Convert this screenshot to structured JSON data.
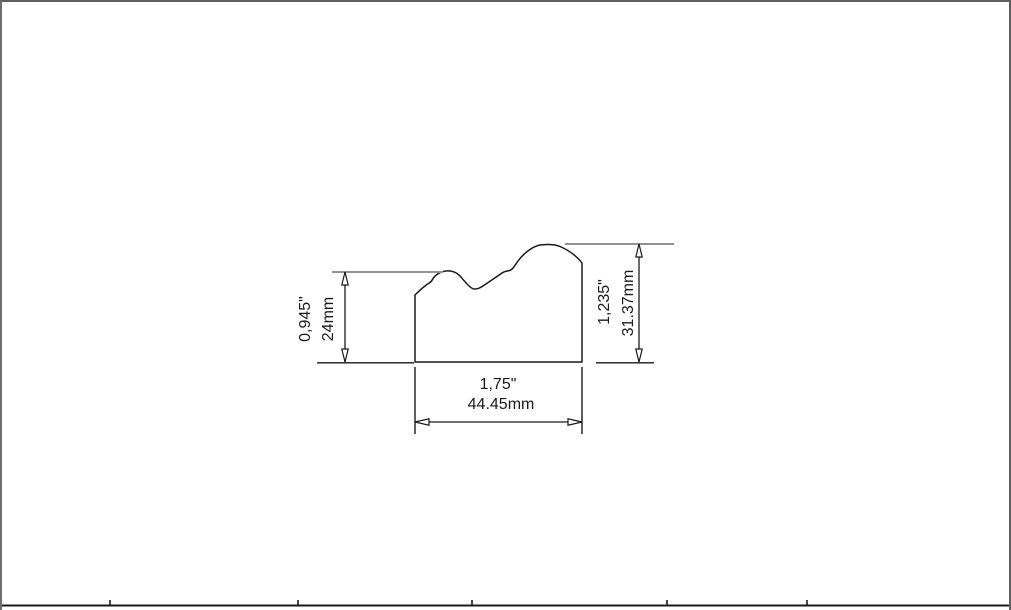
{
  "drawing": {
    "type": "moulding-profile-cross-section",
    "dimensions": {
      "left_height": {
        "inches": "0,945\"",
        "mm": "24mm"
      },
      "right_height": {
        "inches": "1,235\"",
        "mm": "31.37mm"
      },
      "bottom_width": {
        "inches": "1,75\"",
        "mm": "44.45mm"
      }
    },
    "colors": {
      "outline": "#1a1a1a",
      "extension_line": "#929292",
      "frame_border": "#5f5f5f",
      "table_line": "#1a1a1a",
      "background": "#ffffff"
    }
  }
}
